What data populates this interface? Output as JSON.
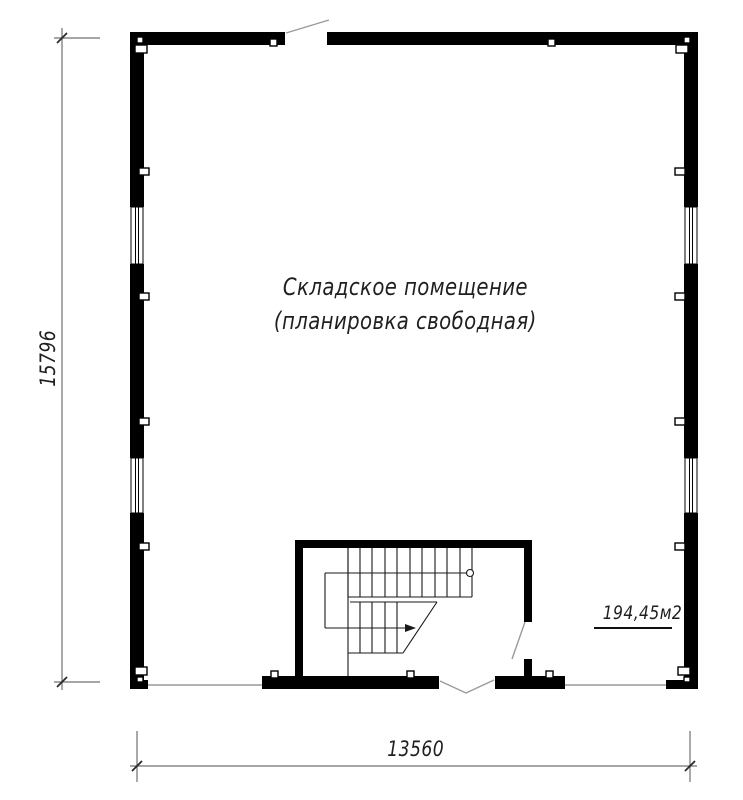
{
  "title": {
    "line1": "Складское помещение",
    "line2": "(планировка свободная)"
  },
  "area": {
    "label": "194,45м2"
  },
  "dims": {
    "left": "15796",
    "bottom": "13560"
  },
  "plan": {
    "room_type": "warehouse",
    "features": [
      "windows-left-wall",
      "windows-right-wall",
      "entry-door-top",
      "stairwell-bottom-center",
      "double-door-bottom",
      "stair-door-right"
    ]
  },
  "colors": {
    "wall": "#000000",
    "thin": "#9a9a9a",
    "stair": "#1a1a1a",
    "dim": "#707070",
    "text": "#1f1f1f",
    "bg": "#ffffff"
  }
}
